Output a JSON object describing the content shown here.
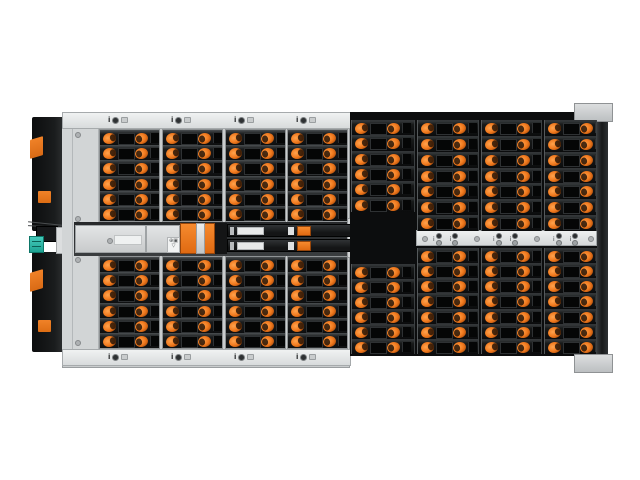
{
  "meta": {
    "subject": "Top view photograph of a high-density rack storage enclosure (JBOD) with orange drive latches",
    "background": "#ffffff"
  },
  "colors": {
    "accent_orange": "#ef7a1e",
    "accent_orange_dark": "#8a3c08",
    "teal_connector": "#2bb7a9",
    "chassis_light": "#d6d9da",
    "drawer_dark": "#0d0e0f",
    "module_black": "#1a1c1d",
    "label_white": "#e9ebeb"
  },
  "bays": {
    "left_section": {
      "columns": 4,
      "rows_top": 6,
      "rows_bottom": 6
    },
    "right_section": {
      "columns": 4,
      "rows_top": 7,
      "rows_bottom": 7,
      "col1_rows_top": 6,
      "col1_rows_bottom": 6
    },
    "total_drive_slots": 102
  },
  "indicators": {
    "bay_group": {
      "i_glyph": "i",
      "icons": [
        "attention-icon",
        "power-led-icon",
        "drive-slot-icon"
      ]
    },
    "mid_rail": {
      "groups": 3,
      "units_per_group": 2,
      "i_glyph": "i"
    }
  },
  "iom": {
    "modules": 2,
    "symbols": "⊙∀▲",
    "dots": "· · ·"
  },
  "mid_modules": {
    "icon_box_glyphs": "⊕▣",
    "icon_box_glyphs2": "▽"
  }
}
